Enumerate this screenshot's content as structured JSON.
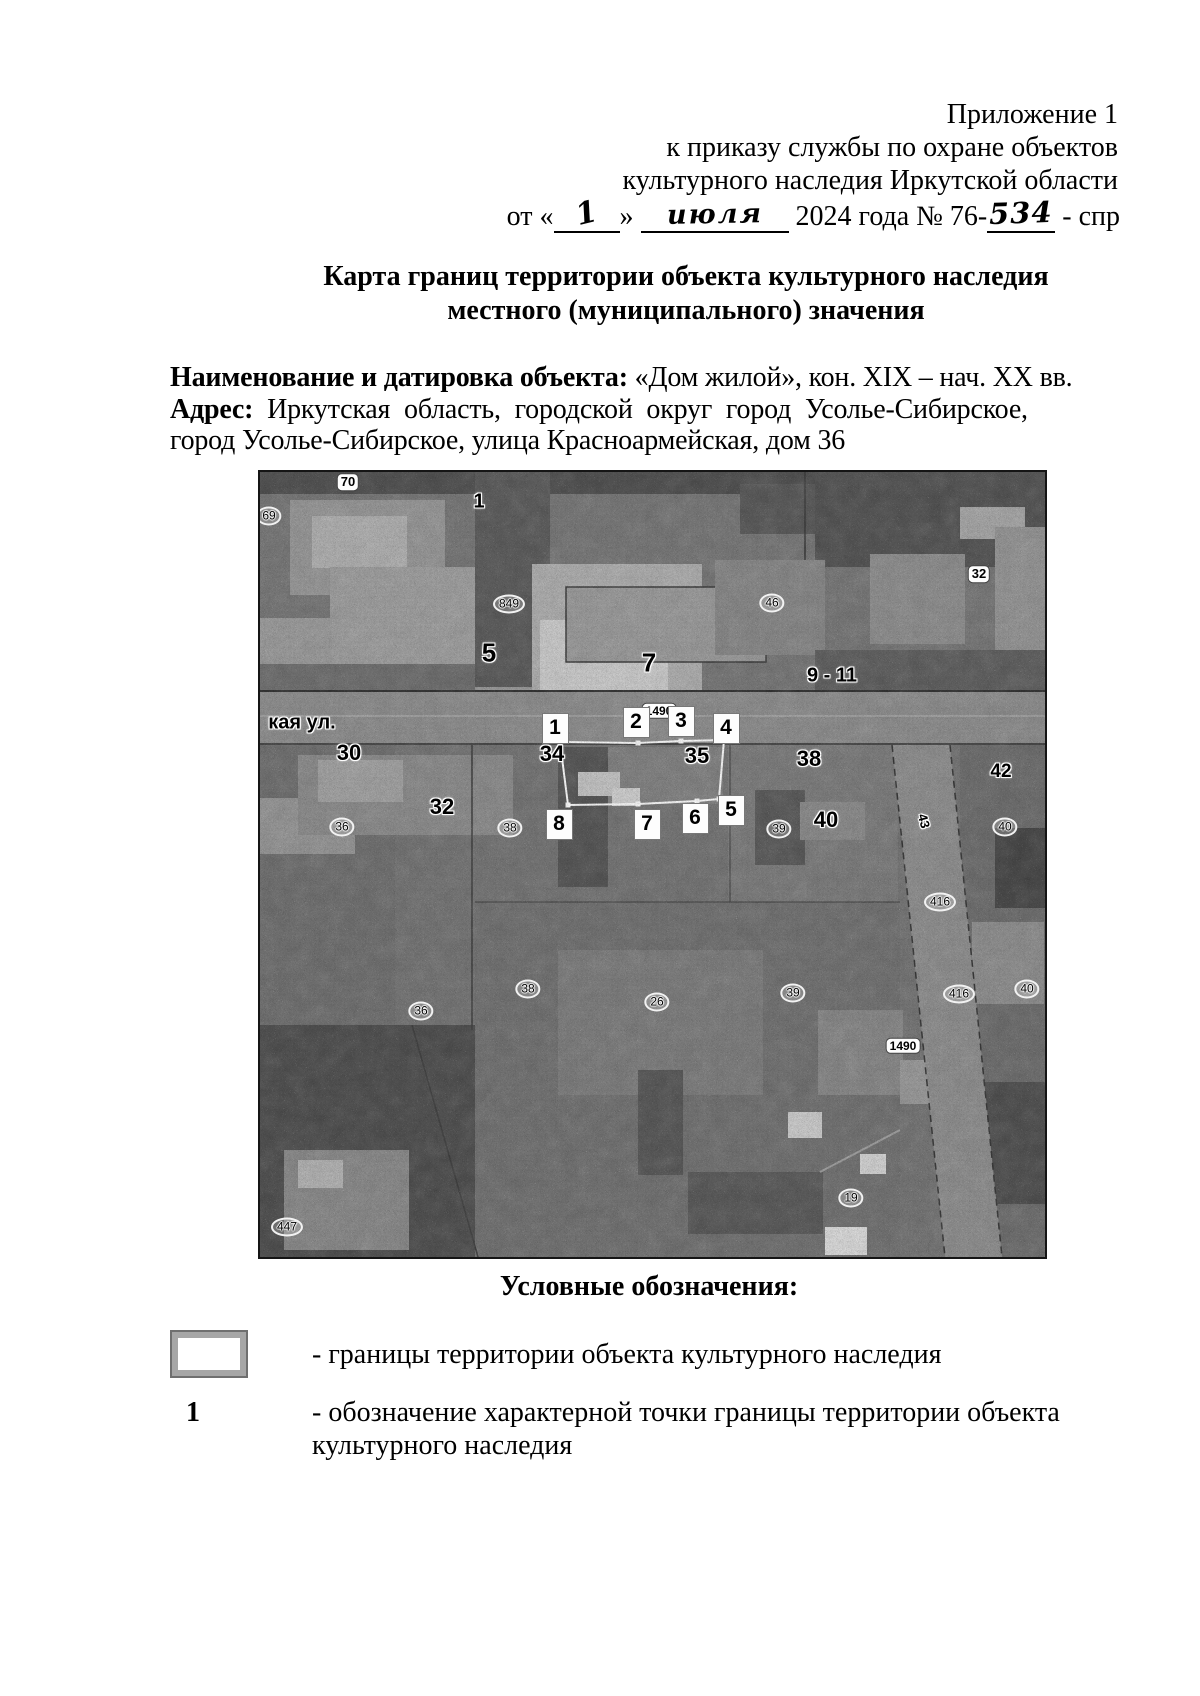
{
  "page": {
    "background": "#ffffff",
    "ink": "#000000"
  },
  "header": {
    "line1": "Приложение 1",
    "line2": "к приказу службы по охране объектов",
    "line3": "культурного наследия Иркутской области",
    "date_line": {
      "prefix": "от «",
      "day_handwritten": "1",
      "after_day": "»",
      "month_handwritten": "июля",
      "middle": "2024 года № 76-",
      "number_handwritten": "534",
      "suffix": "- спр"
    }
  },
  "title": {
    "line1": "Карта границ территории объекта культурного наследия",
    "line2": "местного (муниципального) значения"
  },
  "object_info": {
    "name_label": "Наименование и датировка объекта:",
    "name_value": "«Дом жилой», кон.  XIX – нач. XX вв.",
    "address_label": "Адрес:",
    "address_value": "Иркутская область, городской округ город Усолье-Сибирское,",
    "address_line2": "город Усолье-Сибирское, улица Красноармейская, дом 36"
  },
  "map": {
    "street_label": "кая ул.",
    "markers": [
      {
        "n": "1",
        "x": 295,
        "y": 256
      },
      {
        "n": "2",
        "x": 376,
        "y": 250
      },
      {
        "n": "3",
        "x": 421,
        "y": 249
      },
      {
        "n": "4",
        "x": 466,
        "y": 256
      },
      {
        "n": "5",
        "x": 471,
        "y": 338
      },
      {
        "n": "6",
        "x": 435,
        "y": 346
      },
      {
        "n": "7",
        "x": 387,
        "y": 352
      },
      {
        "n": "8",
        "x": 299,
        "y": 352
      }
    ],
    "boundary": {
      "color": "#ffffff",
      "vertices": [
        [
          300,
          270
        ],
        [
          378,
          271
        ],
        [
          421,
          269
        ],
        [
          464,
          268
        ],
        [
          459,
          327
        ],
        [
          437,
          329
        ],
        [
          378,
          332
        ],
        [
          308,
          333
        ]
      ]
    },
    "parcel_labels": [
      {
        "t": "кая ул.",
        "k": "halo",
        "x": 42,
        "y": 251,
        "s": 20
      },
      {
        "t": "1",
        "k": "halo",
        "x": 219,
        "y": 30,
        "s": 20
      },
      {
        "t": "5",
        "k": "halo",
        "x": 229,
        "y": 181,
        "s": 26
      },
      {
        "t": "7",
        "k": "halo",
        "x": 389,
        "y": 191,
        "s": 26
      },
      {
        "t": "9 - 11",
        "k": "halo",
        "x": 572,
        "y": 204,
        "s": 20
      },
      {
        "t": "34",
        "k": "halo",
        "x": 292,
        "y": 282,
        "s": 22
      },
      {
        "t": "35",
        "k": "halo",
        "x": 437,
        "y": 284,
        "s": 22
      },
      {
        "t": "38",
        "k": "halo",
        "x": 549,
        "y": 287,
        "s": 22
      },
      {
        "t": "30",
        "k": "halo",
        "x": 89,
        "y": 281,
        "s": 22
      },
      {
        "t": "32",
        "k": "halo",
        "x": 182,
        "y": 335,
        "s": 22
      },
      {
        "t": "40",
        "k": "halo",
        "x": 566,
        "y": 348,
        "s": 22
      },
      {
        "t": "42",
        "k": "halo",
        "x": 741,
        "y": 300,
        "s": 19
      },
      {
        "t": "70",
        "k": "pill",
        "x": 88,
        "y": 10,
        "s": 13
      },
      {
        "t": "32",
        "k": "pill",
        "x": 719,
        "y": 102,
        "s": 13
      },
      {
        "t": "1490",
        "k": "pill",
        "x": 399,
        "y": 239,
        "s": 12
      },
      {
        "t": "1490",
        "k": "pill",
        "x": 643,
        "y": 574,
        "s": 12
      },
      {
        "t": "69",
        "k": "oval",
        "x": 9,
        "y": 44,
        "s": 12
      },
      {
        "t": "849",
        "k": "oval",
        "x": 249,
        "y": 132,
        "s": 12
      },
      {
        "t": "46",
        "k": "oval",
        "x": 512,
        "y": 131,
        "s": 12
      },
      {
        "t": "36",
        "k": "oval",
        "x": 82,
        "y": 355,
        "s": 12
      },
      {
        "t": "38",
        "k": "oval",
        "x": 250,
        "y": 356,
        "s": 12
      },
      {
        "t": "39",
        "k": "oval",
        "x": 519,
        "y": 357,
        "s": 12
      },
      {
        "t": "40",
        "k": "oval",
        "x": 745,
        "y": 355,
        "s": 12
      },
      {
        "t": "416",
        "k": "oval",
        "x": 680,
        "y": 430,
        "s": 12
      },
      {
        "t": "38",
        "k": "oval",
        "x": 268,
        "y": 517,
        "s": 12
      },
      {
        "t": "36",
        "k": "oval",
        "x": 161,
        "y": 539,
        "s": 12
      },
      {
        "t": "26",
        "k": "oval",
        "x": 397,
        "y": 530,
        "s": 12
      },
      {
        "t": "39",
        "k": "oval",
        "x": 533,
        "y": 521,
        "s": 12
      },
      {
        "t": "416",
        "k": "oval",
        "x": 699,
        "y": 522,
        "s": 12
      },
      {
        "t": "40",
        "k": "oval",
        "x": 767,
        "y": 517,
        "s": 12
      },
      {
        "t": "19",
        "k": "oval",
        "x": 591,
        "y": 726,
        "s": 12
      },
      {
        "t": "447",
        "k": "oval",
        "x": 27,
        "y": 755,
        "s": 12
      },
      {
        "t": "43",
        "k": "halo",
        "x": 664,
        "y": 349,
        "s": 13,
        "r": 75
      }
    ]
  },
  "legend": {
    "heading": "Условные обозначения:",
    "item1_text": "- границы территории объекта культурного наследия",
    "item2_symbol": "1",
    "item2_text_line1": "- обозначение характерной точки границы территории объекта",
    "item2_text_line2": "культурного наследия"
  }
}
